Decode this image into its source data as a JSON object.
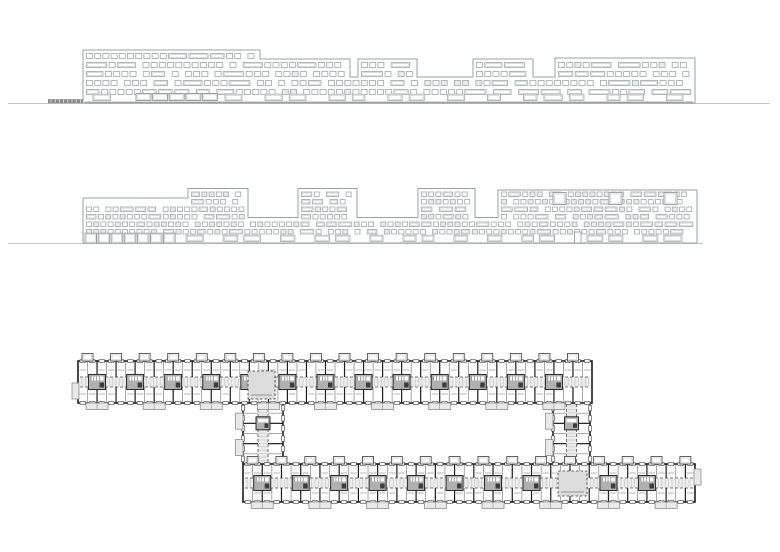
{
  "canvas": {
    "width": 780,
    "height": 552,
    "background": "#ffffff"
  },
  "palette": {
    "elev_outline": "#9aa1a3",
    "elev_line": "#abb1b3",
    "elev_line_light": "#cbd0d1",
    "elev_shade": "#e9ebeb",
    "ground": "#c2c6c7",
    "plinth": "#9da0a1",
    "ramp": "#86898b",
    "plan_wall": "#1c1c1c",
    "plan_mid": "#4f4f4f",
    "plan_thin": "#6e6e6e",
    "plan_light_line": "#c9c9c9",
    "plan_fill": "#ececec",
    "plan_fill_core": "#b0b0b0",
    "plan_fill_balcony": "#e9e9e9",
    "plan_dash_room_fill": "#dcdcdc",
    "white": "#ffffff"
  },
  "elevations": [
    {
      "name": "upper-elevation",
      "seed": 11,
      "ground_line": {
        "y": 103.5,
        "x1": 8,
        "x2": 770
      },
      "plinth_line": {
        "y": 102.3,
        "x1": 85,
        "x2": 693
      },
      "ramp": {
        "x": 48,
        "y": 99.2,
        "w": 60,
        "h": 4
      },
      "ground_y": 103,
      "regions": [
        {
          "x1": 83,
          "x2": 260,
          "top": 50
        },
        {
          "x1": 260,
          "x2": 350,
          "top": 59
        },
        {
          "x1": 350,
          "x2": 358,
          "top": 77
        },
        {
          "x1": 358,
          "x2": 417,
          "top": 59
        },
        {
          "x1": 417,
          "x2": 473,
          "top": 77
        },
        {
          "x1": 473,
          "x2": 533,
          "top": 59
        },
        {
          "x1": 533,
          "x2": 555,
          "top": 77
        },
        {
          "x1": 555,
          "x2": 695,
          "top": 58
        }
      ],
      "rows": [
        53.5,
        62.5,
        71.5,
        80.5,
        89.5
      ],
      "row_h": 5,
      "win_small_w": 6,
      "win_wide_w": 16,
      "wide_prob": 0.33,
      "shade_prob": 0.08,
      "ground_row": {
        "y": 94.2,
        "h": 6.4,
        "box_w": 15,
        "door_h": 10.5,
        "door_w": 5.5,
        "door_prob": 0.1,
        "gap": 7,
        "big_gap": 16,
        "contig": {
          "x1": 136,
          "x2": 218,
          "w": 15,
          "h": 7,
          "y": 93.5
        }
      },
      "big_windows": [],
      "big_w": 0,
      "big_h": 0
    },
    {
      "name": "middle-elevation",
      "seed": 23,
      "ground_line": {
        "y": 243.5,
        "x1": 8,
        "x2": 703
      },
      "plinth_line": null,
      "ramp": null,
      "ground_y": 243,
      "regions": [
        {
          "x1": 83,
          "x2": 188,
          "top": 198
        },
        {
          "x1": 188,
          "x2": 248,
          "top": 188.5
        },
        {
          "x1": 248,
          "x2": 298,
          "top": 217.5
        },
        {
          "x1": 298,
          "x2": 357,
          "top": 188.5
        },
        {
          "x1": 357,
          "x2": 418,
          "top": 217.5
        },
        {
          "x1": 418,
          "x2": 475,
          "top": 188.5
        },
        {
          "x1": 475,
          "x2": 498,
          "top": 217.5
        },
        {
          "x1": 498,
          "x2": 697,
          "top": 190
        }
      ],
      "rows": [
        192,
        199.5,
        207,
        214.5,
        222,
        229.5
      ],
      "row_h": 4.5,
      "win_small_w": 5,
      "win_wide_w": 10,
      "wide_prob": 0.3,
      "shade_prob": 0.3,
      "ground_row": {
        "y": 235.2,
        "h": 6.2,
        "box_w": 14,
        "door_h": 11,
        "door_w": 6.5,
        "door_prob": 0.12,
        "gap": 6,
        "big_gap": 14,
        "contig": {
          "x1": 85,
          "x2": 180,
          "w": 11.5,
          "h": 10,
          "y": 233.2
        }
      },
      "big_windows": [
        {
          "x": 553,
          "y": 192.5
        },
        {
          "x": 609,
          "y": 192.5
        },
        {
          "x": 664,
          "y": 192.5
        }
      ],
      "big_w": 13,
      "big_h": 12
    }
  ],
  "plan": {
    "seed": 7,
    "bay": 9.6,
    "corridor_half": 5,
    "bars": [
      {
        "name": "top-bar",
        "x1": 78,
        "y1": 361,
        "x2": 592,
        "y2": 403,
        "bump_every": 3,
        "balc_every": 6,
        "core_every": 4
      },
      {
        "name": "bottom-bar",
        "x1": 243,
        "y1": 464,
        "x2": 695,
        "y2": 502,
        "bump_every": 3,
        "balc_every": 6,
        "core_every": 4
      }
    ],
    "wings": [
      {
        "name": "left-wing",
        "x1": 243,
        "y1": 403,
        "x2": 283,
        "y2": 464
      },
      {
        "name": "right-wing",
        "x1": 553,
        "y1": 403,
        "x2": 590,
        "y2": 464
      }
    ],
    "bump": {
      "w": 11,
      "h": 7.5
    },
    "balcony": {
      "w": 22,
      "h": 6.5
    },
    "core": {
      "w": 17,
      "h": 15
    },
    "opening": {
      "w": 5.5,
      "h": 2.6
    },
    "wing_balcony": {
      "w": 7.5,
      "h": 16
    },
    "dashed_rooms": [
      {
        "x": 248,
        "y": 371,
        "w": 27,
        "h": 28
      },
      {
        "x": 558,
        "y": 471,
        "w": 29,
        "h": 25
      }
    ],
    "end_caps": [
      {
        "x": 72,
        "y": 383,
        "w": 7,
        "h": 16
      },
      {
        "x": 694,
        "y": 469,
        "w": 7,
        "h": 16
      }
    ]
  }
}
